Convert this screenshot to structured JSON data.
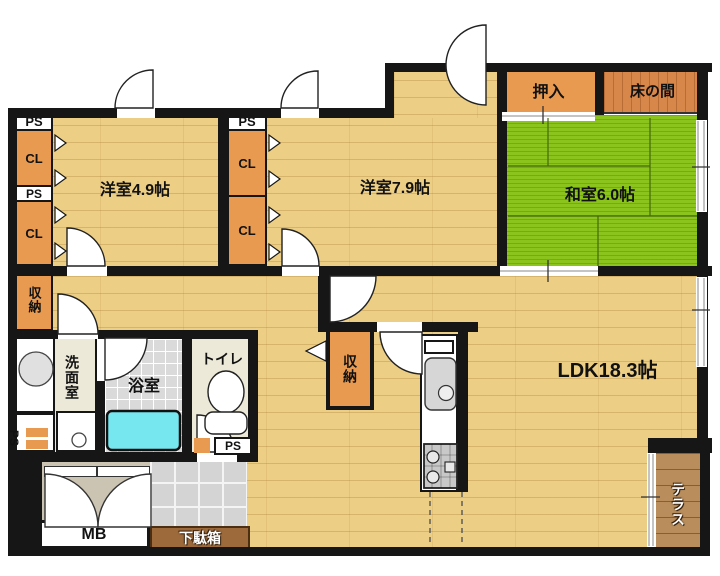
{
  "labels": {
    "western_room_small": "洋室4.9帖",
    "western_room_large": "洋室7.9帖",
    "japanese_room": "和室6.0帖",
    "ldk": "LDK18.3帖",
    "oshiire_closet": "押入",
    "tokonoma_alcove": "床の間",
    "washroom": "洗面室",
    "bathroom": "浴室",
    "toilet": "トイレ",
    "terrace": "テラス",
    "storage": "収納",
    "meter_box": "MB",
    "shoe_cabinet": "下駄箱",
    "closet_abbr": "CL",
    "pipe_space_abbr": "PS"
  },
  "colors": {
    "wall": "#161616",
    "wood_floor": "#ecce85",
    "tatami_green": "#8cc41e",
    "closet_orange": "#e89b50",
    "tokonoma_wood": "#d8874b",
    "bath_tile": "#dadada",
    "service_floor": "#ece9d8",
    "bathtub_cyan": "#76e7ef",
    "entrance_tile": "#d4d4d4",
    "entrance_alcove": "#cbc4b3",
    "shoe_cabinet_brown": "#9c6a3b",
    "terrace_wood": "#b98e5c"
  }
}
